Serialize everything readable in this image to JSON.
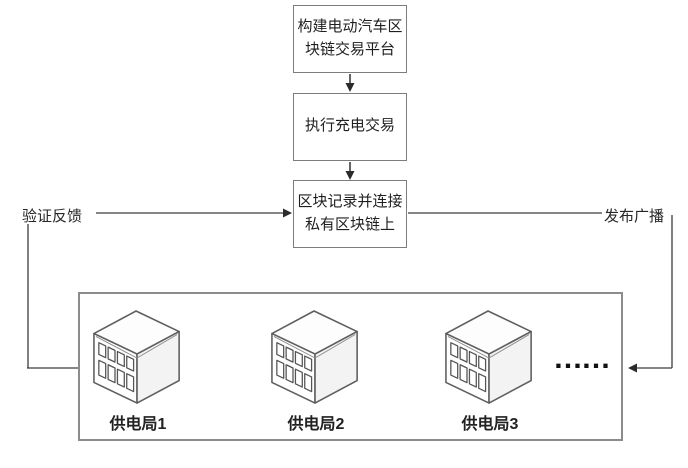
{
  "flow": {
    "box1_label": "构建电动汽车区\n块链交易平台",
    "box2_label": "执行充电交易",
    "box3_label": "区块记录并连接\n私有区块链上"
  },
  "connectors": {
    "left_label": "验证反馈",
    "right_label": "发布广播"
  },
  "stations": {
    "items": [
      {
        "label": "供电局1"
      },
      {
        "label": "供电局2"
      },
      {
        "label": "供电局3"
      }
    ],
    "ellipsis": "……"
  },
  "colors": {
    "line": "#3d3d3d",
    "box_border": "#7d7d7d",
    "container_border": "#8c8c8c",
    "building_outline": "#5f5f5f",
    "text": "#1f1f1f"
  }
}
